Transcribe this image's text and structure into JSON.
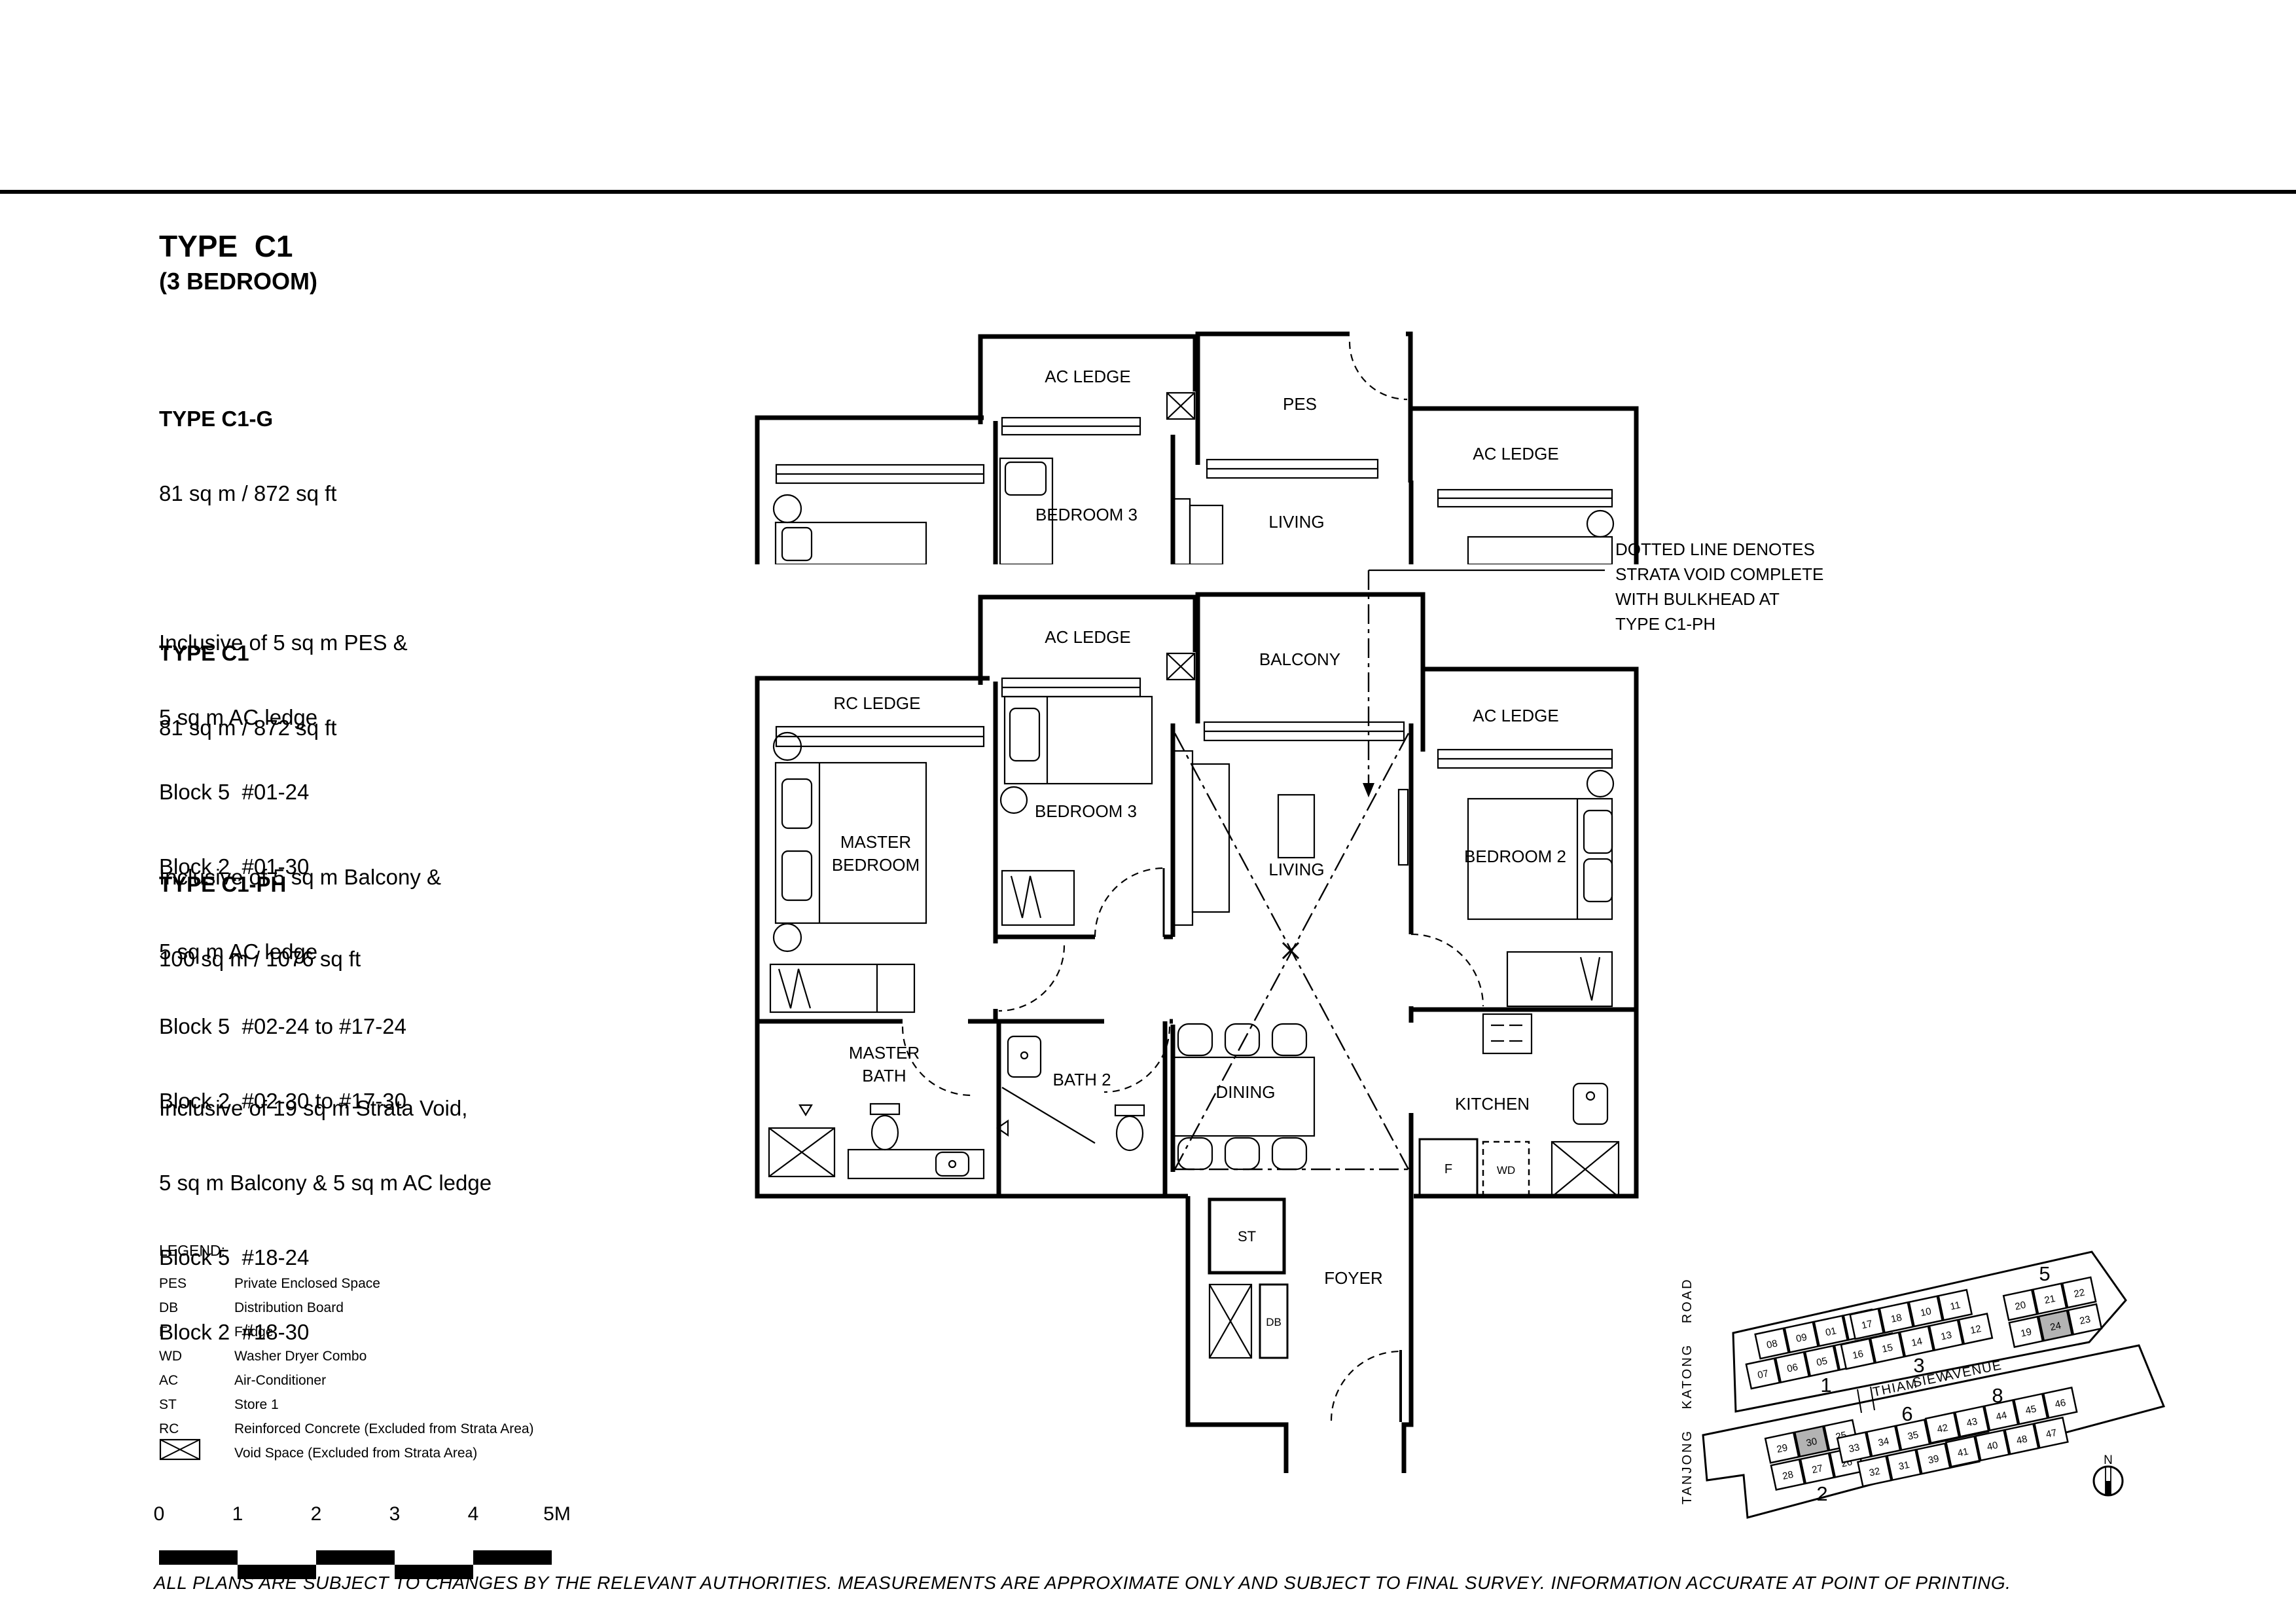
{
  "page": {
    "title": "TYPE  C1",
    "subtitle": "(3 BEDROOM)"
  },
  "colors": {
    "ink": "#000000",
    "background": "#ffffff",
    "highlight": "#b3b3b3"
  },
  "variants": [
    {
      "name": "TYPE C1-G",
      "area": "81 sq m / 872 sq ft",
      "details": [
        "Inclusive of 5 sq m PES &",
        "5 sq m AC ledge",
        "Block 5  #01-24",
        "Block 2  #01-30"
      ]
    },
    {
      "name": "TYPE C1",
      "area": "81 sq m / 872 sq ft",
      "details": [
        "Inclusive of 5 sq m Balcony &",
        "5 sq m AC ledge",
        "Block 5  #02-24 to #17-24",
        "Block 2  #02-30 to #17-30"
      ]
    },
    {
      "name": "TYPE C1-PH",
      "area": "100 sq m / 1076 sq ft",
      "details": [
        "Inclusive of 19 sq m Strata Void,",
        "5 sq m Balcony & 5 sq m AC ledge",
        "Block 5  #18-24",
        "Block 2  #18-30"
      ]
    }
  ],
  "annotation": {
    "lines": [
      "DOTTED LINE DENOTES",
      "STRATA VOID COMPLETE",
      "WITH BULKHEAD AT",
      "TYPE C1-PH"
    ]
  },
  "floor_plan": {
    "labels": {
      "ac_ledge": "AC LEDGE",
      "rc_ledge": "RC LEDGE",
      "pes": "PES",
      "balcony": "BALCONY",
      "bedroom3": "BEDROOM 3",
      "living": "LIVING",
      "master": "MASTER",
      "bedroom": "BEDROOM",
      "bath": "BATH",
      "bedroom2": "BEDROOM 2",
      "bath2": "BATH 2",
      "dining": "DINING",
      "kitchen": "KITCHEN",
      "foyer": "FOYER",
      "store": "ST",
      "db": "DB",
      "fridge": "F",
      "wd": "WD"
    }
  },
  "legend": {
    "title": "LEGEND:",
    "items": [
      {
        "abbr": "PES",
        "desc": "Private Enclosed Space"
      },
      {
        "abbr": "DB",
        "desc": "Distribution Board"
      },
      {
        "abbr": "F",
        "desc": "Fridge"
      },
      {
        "abbr": "WD",
        "desc": "Washer Dryer Combo"
      },
      {
        "abbr": "AC",
        "desc": "Air-Conditioner"
      },
      {
        "abbr": "ST",
        "desc": "Store 1"
      },
      {
        "abbr": "RC",
        "desc": "Reinforced Concrete (Excluded from Strata Area)"
      },
      {
        "abbr": "",
        "desc": "Void Space (Excluded from Strata Area)"
      }
    ]
  },
  "scale_bar": {
    "labels": [
      "0",
      "1",
      "2",
      "3",
      "4",
      "5M"
    ]
  },
  "disclaimer": "ALL PLANS ARE SUBJECT TO CHANGES BY THE RELEVANT AUTHORITIES. MEASUREMENTS ARE APPROXIMATE ONLY AND SUBJECT TO FINAL SURVEY. INFORMATION ACCURATE AT POINT OF PRINTING.",
  "site_plan": {
    "roads": {
      "left": "TANJONG KATONG ROAD",
      "middle": [
        "THIAM",
        "SIEW",
        "AVENUE"
      ]
    },
    "north_label": "N",
    "highlight_color": "#b3b3b3",
    "blocks": [
      {
        "label": "1",
        "rows": [
          [
            "08",
            "09",
            "01",
            "02"
          ],
          [
            "07",
            "06",
            "05",
            "04",
            "03"
          ]
        ],
        "highlight": []
      },
      {
        "label": "3",
        "rows": [
          [
            "17",
            "18",
            "10",
            "11"
          ],
          [
            "16",
            "15",
            "14",
            "13",
            "12"
          ]
        ],
        "highlight": []
      },
      {
        "label": "5",
        "rows": [
          [
            "20",
            "21",
            "22"
          ],
          [
            "19",
            "24",
            "23"
          ]
        ],
        "highlight": [
          "24"
        ]
      },
      {
        "label": "2",
        "rows": [
          [
            "29",
            "30",
            "25"
          ],
          [
            "28",
            "27",
            "26"
          ]
        ],
        "highlight": [
          "30"
        ]
      },
      {
        "label": "6",
        "rows": [
          [
            "33",
            "34",
            "35",
            "36",
            "37"
          ],
          [
            "32",
            "31",
            "39",
            "38"
          ]
        ],
        "highlight": []
      },
      {
        "label": "8",
        "rows": [
          [
            "42",
            "43",
            "44",
            "45",
            "46"
          ],
          [
            "41",
            "40",
            "48",
            "47"
          ]
        ],
        "highlight": []
      }
    ]
  }
}
